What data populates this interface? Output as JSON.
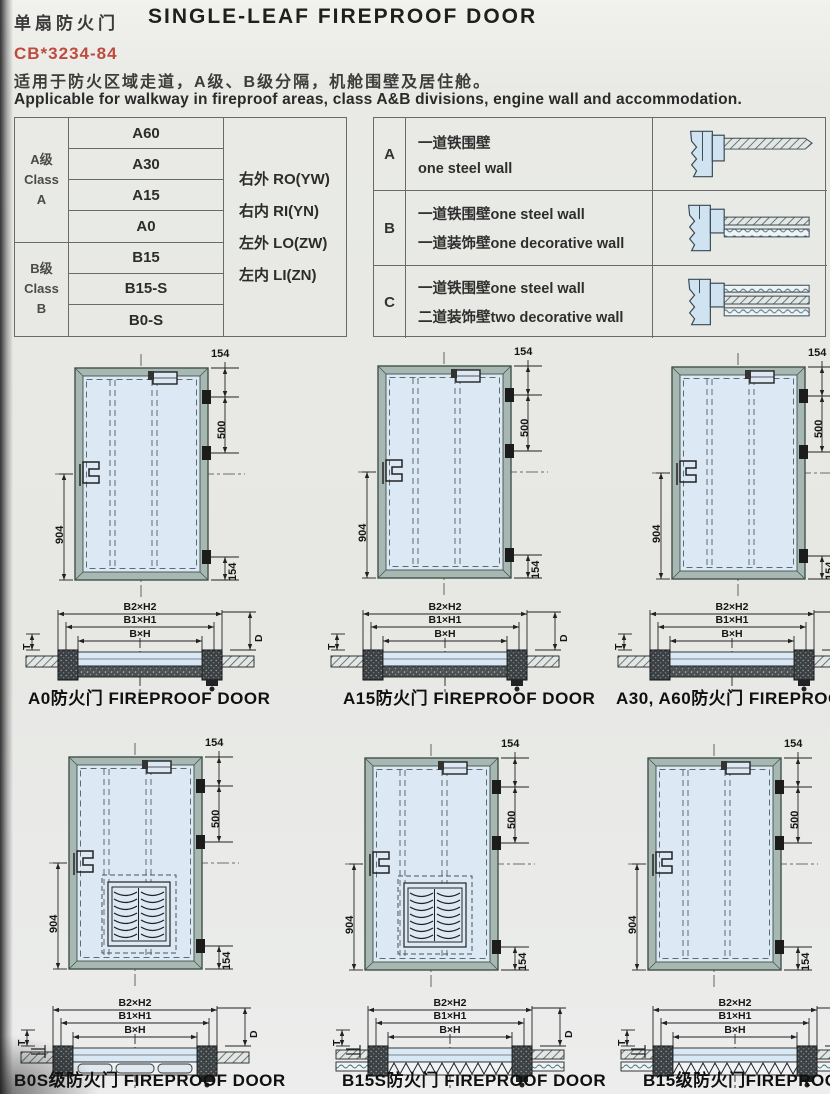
{
  "header": {
    "title_cn": "单扇防火门",
    "title_en": "SINGLE-LEAF FIREPROOF DOOR",
    "standard": "CB*3234-84",
    "desc_cn": "适用于防火区域走道，A级、B级分隔，机舱围壁及居住舱。",
    "desc_en": "Applicable for walkway in fireproof areas, class A&B divisions, engine wall and accommodation."
  },
  "class_table": {
    "group_a": {
      "lines": [
        "A级",
        "Class",
        "A"
      ],
      "ratings": [
        "A60",
        "A30",
        "A15",
        "A0"
      ]
    },
    "group_b": {
      "lines": [
        "B级",
        "Class",
        "B"
      ],
      "ratings": [
        "B15",
        "B15-S",
        "B0-S"
      ]
    },
    "orientations": [
      "右外 RO(YW)",
      "右内 RI(YN)",
      "左外 LO(ZW)",
      "左内 LI(ZN)"
    ]
  },
  "wall_table": {
    "rows": [
      {
        "key": "A",
        "line1": "一道铁围壁",
        "line2": "one steel wall"
      },
      {
        "key": "B",
        "line1": "一道铁围壁one steel wall",
        "line2": "一道装饰壁one decorative wall"
      },
      {
        "key": "C",
        "line1": "一道铁围壁one steel wall",
        "line2": "二道装饰壁two decorative wall"
      }
    ]
  },
  "door_dims": {
    "top": "154",
    "hinge_span": "500",
    "height": "904",
    "bottom": "154"
  },
  "section_dims": {
    "outer": "B2×H2",
    "middle": "B1×H1",
    "inner": "B×H",
    "depth": "D",
    "thickness": "T"
  },
  "captions": {
    "a0": "A0防火门 FIREPROOF DOOR",
    "a15": "A15防火门 FIREPROOF DOOR",
    "a30a60": "A30, A60防火门 FIREPROOF DOOR",
    "b0s": "B0S级防火门 FIREPROOF DOOR",
    "b15s": "B15S防火门 FIREPROOF DOOR",
    "b15": "B15级防火门FIREPROOF DOOR"
  },
  "colors": {
    "accent_red": "#bf4a3e",
    "door_panel_blue": "#dce9f5",
    "door_frame_gray": "#a7b7b1",
    "line_dark": "#222222",
    "page_background": "#e9eae6"
  }
}
